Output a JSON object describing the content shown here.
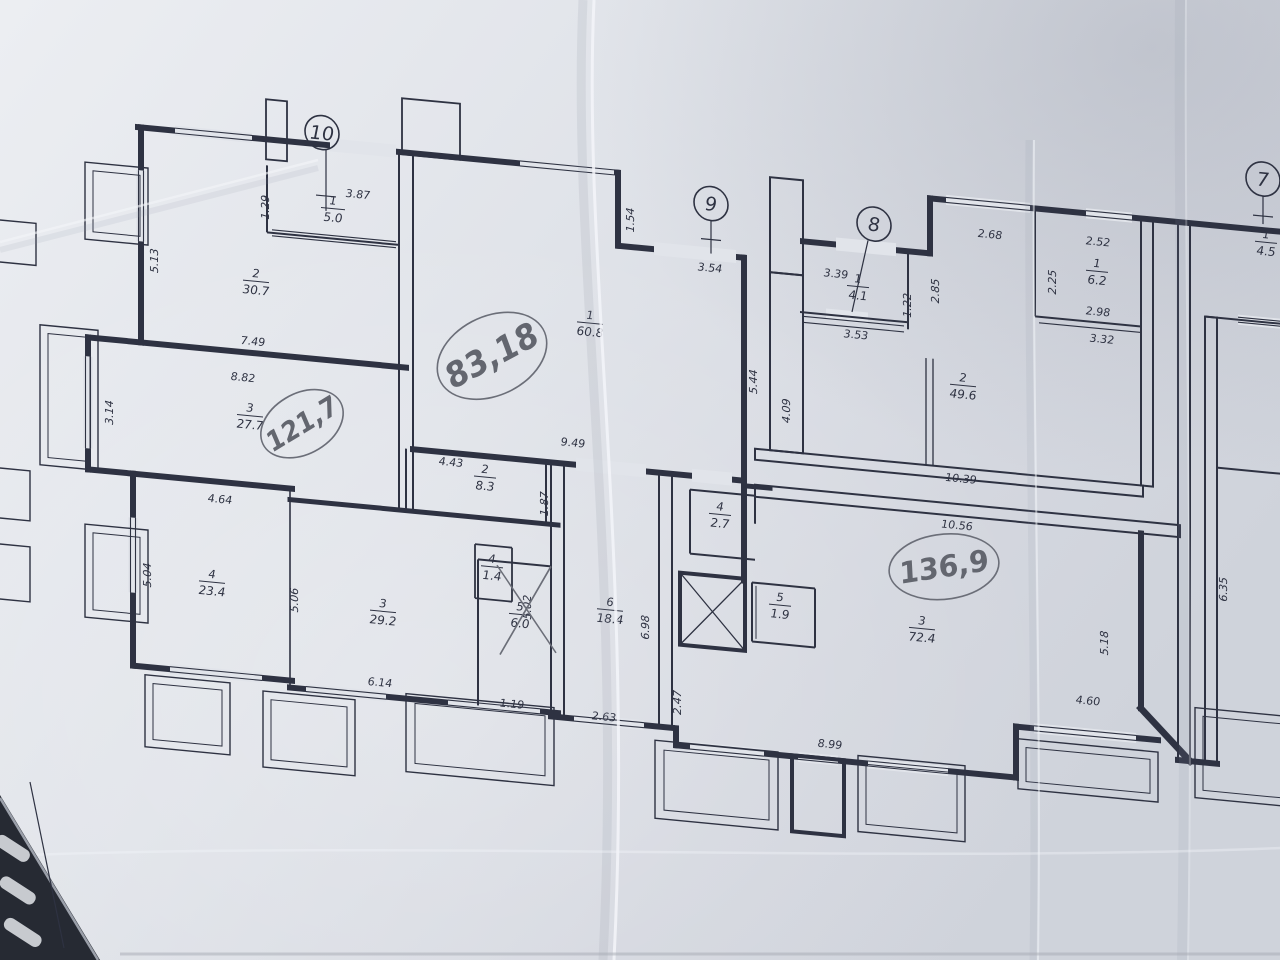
{
  "colors": {
    "ink": "#2e3242",
    "pencil": "#6b6e78",
    "paper_light": "#eceef2",
    "paper_dark": "#cfd3db",
    "table_dark": "#262a33"
  },
  "plan": {
    "apartments": [
      {
        "marker": "10"
      },
      {
        "marker": "9"
      },
      {
        "marker": "8"
      },
      {
        "marker": "7"
      }
    ],
    "handwritten": [
      {
        "text": "121,7"
      },
      {
        "text": "83,18"
      },
      {
        "text": "136,9"
      }
    ],
    "rooms": [
      {
        "num": "1",
        "area": "5.0"
      },
      {
        "num": "2",
        "area": "30.7"
      },
      {
        "num": "3",
        "area": "27.7"
      },
      {
        "num": "4",
        "area": "23.4"
      },
      {
        "num": "3",
        "area": "29.2"
      },
      {
        "num": "2",
        "area": "8.3"
      },
      {
        "num": "4",
        "area": "1.4"
      },
      {
        "num": "5",
        "area": "6.0"
      },
      {
        "num": "6",
        "area": "18.4"
      },
      {
        "num": "1",
        "area": "60.8"
      },
      {
        "num": "4",
        "area": "2.7"
      },
      {
        "num": "5",
        "area": "1.9"
      },
      {
        "num": "1",
        "area": "4.1"
      },
      {
        "num": "2",
        "area": "49.6"
      },
      {
        "num": "1",
        "area": "6.2"
      },
      {
        "num": "3",
        "area": "72.4"
      },
      {
        "num": "1",
        "area": "4.5"
      }
    ],
    "dims": [
      "3.87",
      "1.29",
      "5.13",
      "7.49",
      "8.82",
      "3.14",
      "4.64",
      "5.04",
      "5.06",
      "6.14",
      "1.19",
      "4.43",
      "1.87",
      "5.02",
      "9.49",
      "1.54",
      "3.54",
      "5.44",
      "4.09",
      "6.98",
      "2.63",
      "2.47",
      "8.99",
      "3.39",
      "3.53",
      "1.22",
      "2.85",
      "2.68",
      "2.52",
      "2.98",
      "3.32",
      "2.25",
      "10.39",
      "10.56",
      "5.18",
      "4.60",
      "6.35"
    ]
  }
}
